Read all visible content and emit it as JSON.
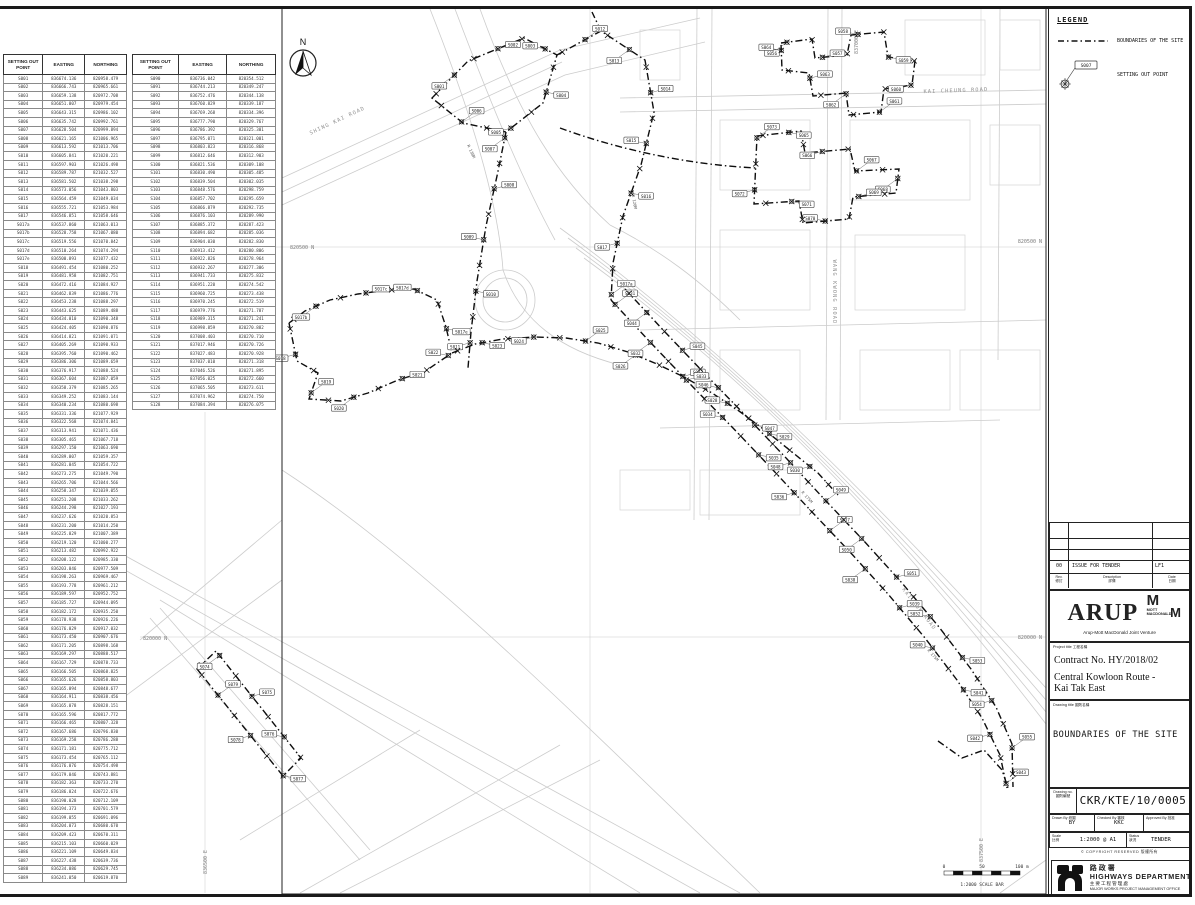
{
  "legend": {
    "title": "LEGEND",
    "boundary_label": "BOUNDARIES OF THE SITE",
    "point_label": "SETTING OUT POINT",
    "point_symbol_id": "S007"
  },
  "tables": {
    "col1": "SETTING OUT POINT",
    "col2": "EASTING",
    "col3": "NORTHING",
    "table1": [
      "S001|836674.136|820958.479",
      "S002|836666.743|820965.661",
      "S003|836659.138|820972.708",
      "S004|836651.007|820979.454",
      "S005|836643.315|820986.102",
      "S006|836635.742|820992.761",
      "S007|836628.504|820999.894",
      "S008|836621.165|821006.965",
      "S009|836613.592|821013.706",
      "S010|836605.841|821020.221",
      "S011|836597.903|821026.498",
      "S012|836589.787|821032.527",
      "S013|836581.502|821038.298",
      "S014|836573.056|821043.803",
      "S015|836564.459|821049.034",
      "S016|836555.721|821053.984",
      "S017|836546.851|821058.646",
      "S017a|836537.860|821063.013",
      "S017b|836528.758|821067.080",
      "S017c|836519.556|821070.842",
      "S017d|836510.264|821074.294",
      "S017e|836500.893|821077.432",
      "S018|836491.454|821080.252",
      "S019|836481.958|821082.751",
      "S020|836472.416|821084.927",
      "S021|836462.839|821086.776",
      "S022|836453.238|821088.297",
      "S023|836443.625|821089.488",
      "S024|836434.010|821090.348",
      "S025|836424.405|821090.876",
      "S026|836414.821|821091.071",
      "S027|836405.269|821090.933",
      "S028|836395.760|821090.462",
      "S029|836386.306|821089.659",
      "S030|836376.917|821088.524",
      "S031|836367.604|821087.059",
      "S032|836358.379|821085.265",
      "S033|836349.252|821083.144",
      "S034|836340.234|821080.698",
      "S035|836331.336|821077.929",
      "S036|836322.568|821074.841",
      "S037|836313.941|821071.436",
      "S038|836305.465|821067.718",
      "S039|836297.150|821063.690",
      "S040|836289.007|821059.357",
      "S041|836281.045|821054.722",
      "S042|836273.275|821049.790",
      "S043|836265.706|821044.566",
      "S044|836258.347|821039.055",
      "S045|836251.208|821033.262",
      "S046|836244.298|821027.193",
      "S047|836237.626|821020.853",
      "S048|836231.200|821014.250",
      "S049|836225.029|821007.389",
      "S050|836219.120|821000.277",
      "S051|836213.482|820992.922",
      "S052|836208.122|820985.330",
      "S053|836203.046|820977.509",
      "S054|836198.263|820969.467",
      "S055|836193.778|820961.212",
      "S056|836189.597|820952.752",
      "S057|836185.727|820944.095",
      "S058|836182.172|820935.250",
      "S059|836178.938|820926.226",
      "S060|836176.029|820917.032",
      "S061|836173.450|820907.676",
      "S062|836171.205|820898.168",
      "S063|836169.297|820888.517",
      "S064|836167.729|820878.733",
      "S065|836166.505|820868.825",
      "S066|836165.626|820858.803",
      "S067|836165.094|820848.677",
      "S068|836164.911|820838.456",
      "S069|836165.078|820828.151",
      "S070|836165.596|820817.772",
      "S071|836166.465|820807.328",
      "S072|836167.686|820796.830",
      "S073|836169.258|820786.288",
      "S074|836171.181|820775.712",
      "S075|836173.454|820765.112",
      "S076|836176.076|820754.498",
      "S077|836179.046|820743.881",
      "S078|836182.363|820733.270",
      "S079|836186.024|820722.676",
      "S080|836190.028|820712.109",
      "S081|836194.373|820701.579",
      "S082|836199.055|820691.096",
      "S083|836204.073|820680.670",
      "S084|836209.423|820670.311",
      "S085|836215.103|820660.029",
      "S086|836221.109|820649.834",
      "S087|836227.438|820639.736",
      "S088|836234.086|820629.745",
      "S089|836241.050|820619.870"
    ],
    "table2": [
      "S090|836736.042|820354.512",
      "S091|836744.213|820349.247",
      "S092|836752.476|820344.138",
      "S093|836760.829|820339.187",
      "S094|836769.268|820334.396",
      "S095|836777.790|820329.767",
      "S096|836786.392|820325.301",
      "S097|836795.071|820321.001",
      "S098|836803.823|820316.868",
      "S099|836812.646|820312.903",
      "S100|836821.536|820309.108",
      "S101|836830.490|820305.485",
      "S102|836839.504|820302.035",
      "S103|836848.576|820298.759",
      "S104|836857.702|820295.659",
      "S105|836866.879|820292.735",
      "S106|836876.103|820289.990",
      "S107|836885.372|820287.423",
      "S108|836894.682|820285.036",
      "S109|836904.030|820282.830",
      "S110|836913.412|820280.806",
      "S111|836922.826|820278.964",
      "S112|836932.267|820277.306",
      "S113|836941.733|820275.832",
      "S114|836951.220|820274.542",
      "S115|836960.725|820273.438",
      "S116|836970.245|820272.519",
      "S117|836979.776|820271.787",
      "S118|836989.315|820271.241",
      "S119|836998.859|820270.882",
      "S120|837008.403|820270.710",
      "S121|837017.946|820270.726",
      "S122|837027.483|820270.928",
      "S123|837037.010|820271.318",
      "S124|837046.526|820271.895",
      "S125|837056.025|820272.660",
      "S126|837065.505|820273.611",
      "S127|837074.962|820274.750",
      "S128|837084.394|820276.075"
    ]
  },
  "map": {
    "north": "N",
    "road_labels": [
      {
        "text": "SHING KAI ROAD",
        "x": 338,
        "y": 122,
        "rot": -25
      },
      {
        "text": "KAI CHEUNG ROAD",
        "x": 956,
        "y": 92,
        "rot": -2
      },
      {
        "text": "WANG KWONG ROAD",
        "x": 833,
        "y": 292,
        "rot": 90
      },
      {
        "text": "KAI FUK ROAD",
        "x": 918,
        "y": 610,
        "rot": 52
      }
    ],
    "grid_labels": [
      {
        "text": "820500 N",
        "x": 290,
        "y": 249,
        "rot": 0,
        "anchor": "start"
      },
      {
        "text": "820500 N",
        "x": 1042,
        "y": 243,
        "rot": 0,
        "anchor": "end"
      },
      {
        "text": "820000 N",
        "x": 143,
        "y": 640,
        "rot": 0,
        "anchor": "start"
      },
      {
        "text": "820000 N",
        "x": 1042,
        "y": 639,
        "rot": 0,
        "anchor": "end"
      },
      {
        "text": "836500 E",
        "x": 207,
        "y": 386,
        "rot": -90,
        "anchor": "middle"
      },
      {
        "text": "836500 E",
        "x": 207,
        "y": 862,
        "rot": -90,
        "anchor": "middle"
      },
      {
        "text": "837000 E",
        "x": 858,
        "y": 42,
        "rot": -90,
        "anchor": "middle"
      },
      {
        "text": "837500 E",
        "x": 983,
        "y": 850,
        "rot": -90,
        "anchor": "middle"
      }
    ],
    "radius_labels": [
      {
        "text": "R 175M",
        "x": 806,
        "y": 498,
        "rot": 48
      },
      {
        "text": "R 120M",
        "x": 633,
        "y": 202,
        "rot": 80
      },
      {
        "text": "R 130M",
        "x": 470,
        "y": 152,
        "rot": 65
      },
      {
        "text": "R 175M",
        "x": 932,
        "y": 656,
        "rot": 48
      }
    ],
    "scalebar": {
      "t0": "0",
      "t50": "50",
      "t100": "100 m",
      "caption": "1:2000 SCALE BAR"
    }
  },
  "title_block": {
    "revision": {
      "rev_no": "00",
      "rev_desc": "ISSUE FOR TENDER",
      "rev_right": "LF1",
      "h_rev": "Rev.",
      "h_rev_cn": "修訂",
      "h_desc": "Description",
      "h_desc_cn": "詳情",
      "h_date": "Date",
      "h_date_cn": "日期"
    },
    "firm": {
      "arup": "ARUP",
      "m1": "M",
      "m2": "M",
      "mott": "MOTT",
      "macdonald": "MACDONALD",
      "jv": "Arup-Mott MacDonald Joint Venture"
    },
    "project": {
      "label": "Project title",
      "label_cn": "工程名稱",
      "contract": "Contract No. HY/2018/02",
      "name_line1": "Central Kowloon Route -",
      "name_line2": "Kai Tak East"
    },
    "drawing": {
      "label": "Drawing title",
      "label_cn": "圖則名稱",
      "title": "BOUNDARIES OF THE SITE"
    },
    "number": {
      "label": "Drawing no.",
      "label_cn": "圖則編號",
      "value": "CKR/KTE/10/0005"
    },
    "people": {
      "drawn_label": "Drawn By",
      "drawn_cn": "繪圖",
      "drawn": "BY",
      "checked_label": "Checked By",
      "checked_cn": "審核",
      "checked": "KKC",
      "approved_label": "Approved By",
      "approved_cn": "批准"
    },
    "scale": {
      "label": "Scale",
      "label_cn": "比例",
      "value": "1:2000 @ A1",
      "status_label": "Status",
      "status_cn": "狀況",
      "status": "TENDER"
    },
    "copyright": "© COPYRIGHT RESERVED  版權所有",
    "dept": {
      "cn": "路政署",
      "en": "HIGHWAYS DEPARTMENT",
      "office_cn": "主要工程管理處",
      "office_en": "MAJOR WORKS PROJECT MANAGEMENT OFFICE"
    }
  }
}
